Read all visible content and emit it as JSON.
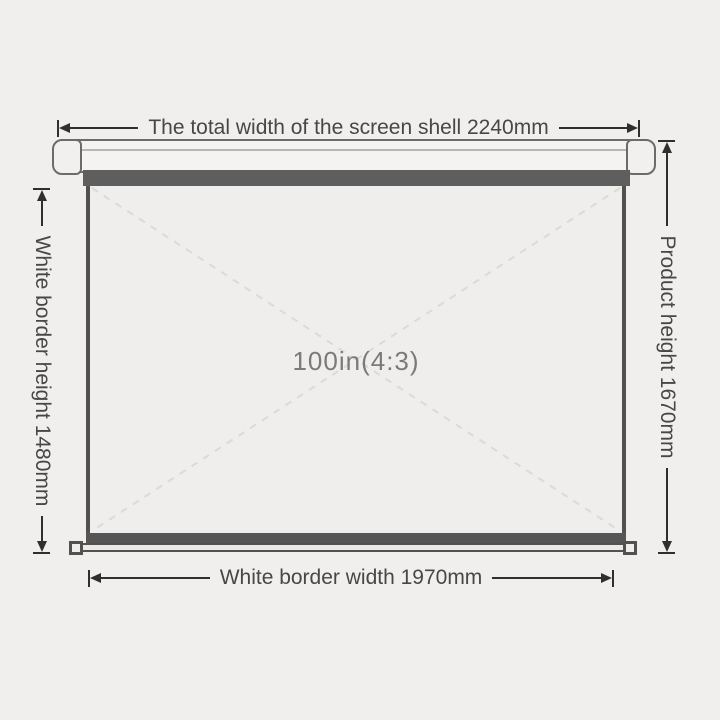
{
  "diagram": {
    "type": "product-dimension-diagram",
    "product": "projection screen"
  },
  "dimensions": {
    "total_width": {
      "label": "The total width of the screen shell 2240mm",
      "value_mm": 2240
    },
    "white_border_height": {
      "label": "White border height 1480mm",
      "value_mm": 1480
    },
    "product_height": {
      "label": "Product height 1670mm",
      "value_mm": 1670
    },
    "white_border_width": {
      "label": "White border width 1970mm",
      "value_mm": 1970
    }
  },
  "screen": {
    "size_label": "100in(4:3)",
    "diagonal_in": 100,
    "aspect_ratio": "4:3"
  },
  "colors": {
    "background": "#f0efed",
    "dimension_text": "#474747",
    "dimension_line": "#2f2f2f",
    "shell_outline": "#6b6b6b",
    "shell_fill": "#f4f3f1",
    "slot_bar": "#5e5e5e",
    "screen_fill": "#efeeec",
    "screen_edge": "#515151",
    "screen_bottom_bar": "#565656",
    "diagonal_dash": "#ddd9d3",
    "screen_label_text": "#7a7a7a"
  }
}
